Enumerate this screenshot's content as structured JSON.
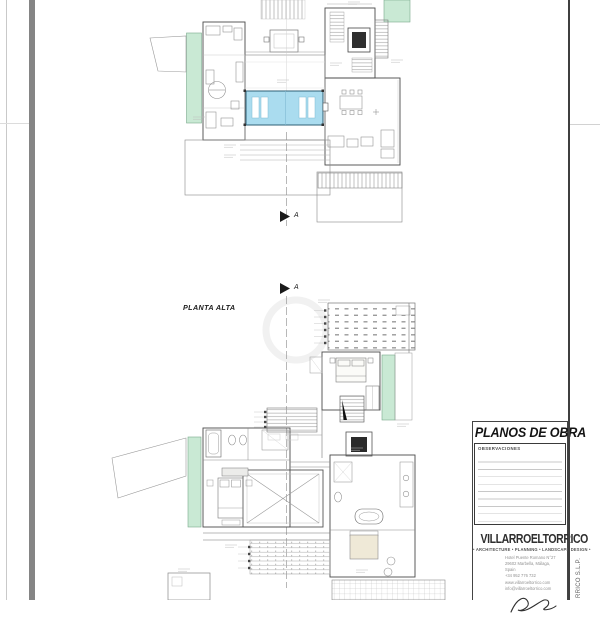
{
  "plans": {
    "upper_floor_label": "PLANTA ALTA",
    "section_marker_top": "A",
    "section_marker_bottom": "A"
  },
  "title_block": {
    "title": "PLANOS DE OBRA",
    "observations_label": "OBSERVACIONES",
    "logo_text": "VILLARROELTORRICO",
    "tagline": "• ARCHITECTURE • PLANNING • LANDSCAPE DESIGN •",
    "address_lines": [
      "Hotel Puente Romano N°27",
      "29602 Marbella, Málaga, Spain",
      "+34 952 776 732",
      "www.villarroeltorrico.com",
      "info@villarroeltorrico.com"
    ],
    "side_text": "RRICO S.L.P."
  },
  "colors": {
    "pool_fill": "#aadcef",
    "planter_fill": "#c9e9d4",
    "wall_line": "#4a4a4a"
  }
}
